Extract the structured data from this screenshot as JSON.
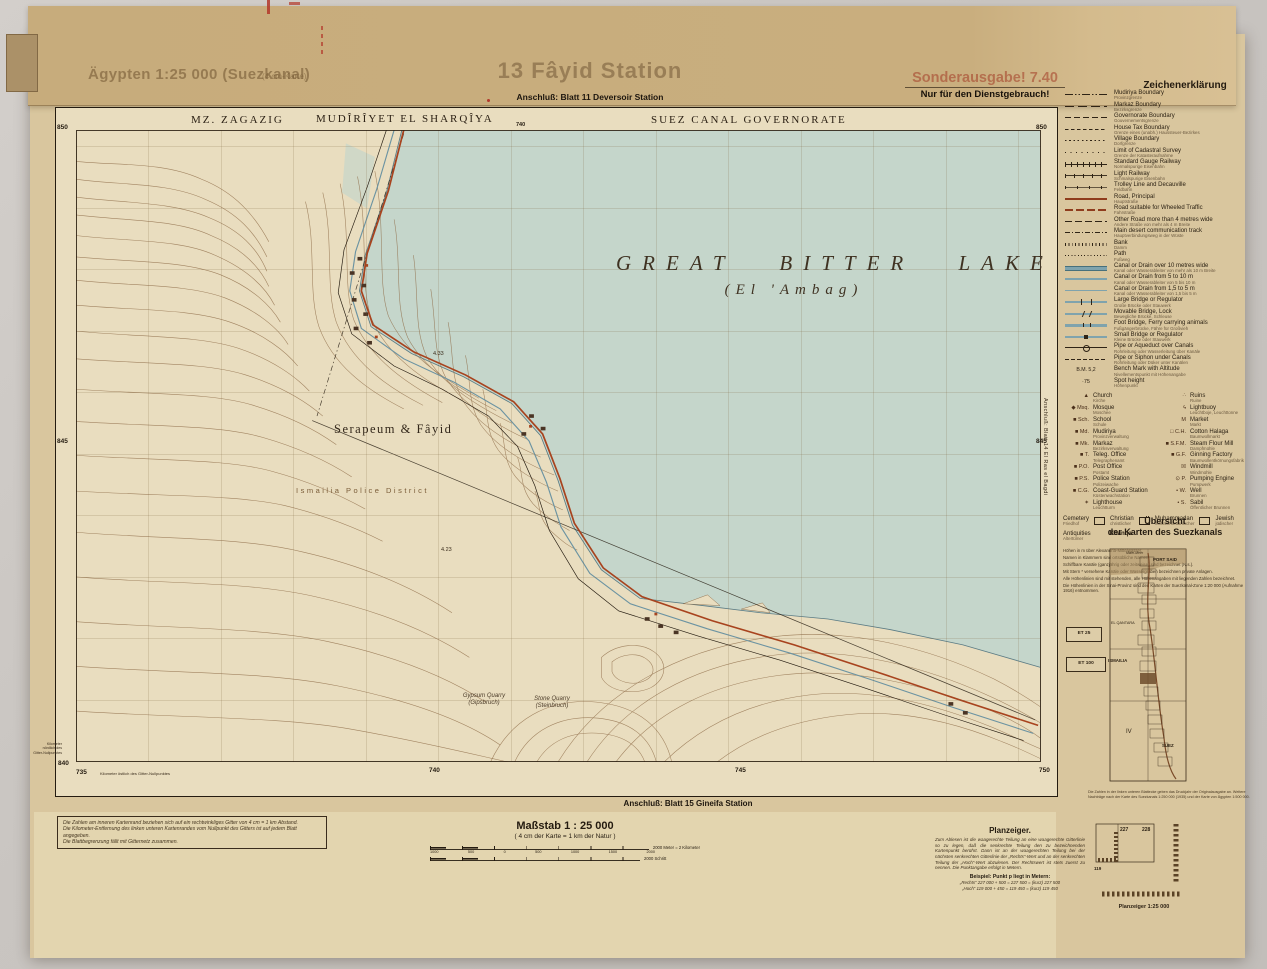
{
  "header": {
    "series_title": "Ägypten 1:25 000 (Suezkanal)",
    "series_note": "(4 cm-Karte)",
    "sheet_title": "13 Fâyid Station",
    "adjoin_top": "Anschluß: Blatt 11 Deversoir Station",
    "edition": "Sonderausgabe! 7.40",
    "restriction": "Nur für den Dienstgebrauch!"
  },
  "map": {
    "admin_left": "MZ. ZAGAZIG",
    "admin_center": "MUDÎRÎYET EL SHARQÎYA",
    "admin_right": "SUEZ CANAL GOVERNORATE",
    "lake_title": "GREAT BITTER LAKE",
    "lake_subtitle": "(El 'Ambag)",
    "place_serapeum": "Serapeum & Fâyid",
    "place_police": "Ismailia Police District",
    "quarry1_en": "Gypsum Quarry",
    "quarry1_de": "(Gipsbruch)",
    "quarry2_en": "Stone Quarry",
    "quarry2_de": "(Steinbruch)",
    "spot1": "4.33",
    "spot2": "4.23",
    "grid": {
      "left_850": "850",
      "left_845": "845",
      "left_840": "840",
      "right_850": "850",
      "right_845": "845",
      "top_740": "740",
      "bottom_735": "735",
      "bottom_740": "740",
      "bottom_745": "745",
      "bottom_750": "750"
    },
    "adjoin_bottom": "Anschluß: Blatt 15 Gineifa Station",
    "adjoin_right": "Anschluß: Blatt 14 El Ras el Bagdi",
    "margin_note_vertical": "Kilometer\nnördlich des\nGitter-Nullpunktes",
    "margin_note_bottom": "Kilometer östlich des Gitter-Nullpunktes"
  },
  "legend": {
    "title": "Zeichenerklärung",
    "items": [
      {
        "en": "Mudiriya Boundary",
        "de": "Provinzgrenze",
        "sym": "dashdotdot"
      },
      {
        "en": "Markaz Boundary",
        "de": "Bezirksgrenze",
        "sym": "dashlong"
      },
      {
        "en": "Governorate Boundary",
        "de": "Gouvernementsgrenze",
        "sym": "dashmed"
      },
      {
        "en": "House Tax Boundary",
        "de": "Grenze eines (unabh.) Haussteuer-Bezirkes",
        "sym": "dashfine"
      },
      {
        "en": "Village Boundary",
        "de": "Dorfgrenze",
        "sym": "dotline"
      },
      {
        "en": "Limit of Cadastral Survey",
        "de": "Grenze der Katasteraufnahme",
        "sym": "dotsparse"
      },
      {
        "en": "Standard Gauge Railway",
        "de": "Normalspurige Eisenbahn",
        "sym": "rail"
      },
      {
        "en": "Light Railway",
        "de": "Schmalspurige Eisenbahn",
        "sym": "raillight"
      },
      {
        "en": "Trolley Line and Decauville",
        "de": "Feldbahn",
        "sym": "trolley"
      },
      {
        "en": "Road, Principal",
        "de": "Hauptstraße",
        "sym": "roadmain"
      },
      {
        "en": "Road suitable for Wheeled Traffic",
        "de": "Fahrstraße",
        "sym": "roadwheel"
      },
      {
        "en": "Other Road more than 4 metres wide",
        "de": "Andere Straße von mehr als 4 m Breite",
        "sym": "roadother"
      },
      {
        "en": "Main desert communication track",
        "de": "Hauptverbindungsweg in der Wüste",
        "sym": "deserttrack"
      },
      {
        "en": "Bank",
        "de": "Damm",
        "sym": "bank"
      },
      {
        "en": "Path",
        "de": "Fußweg",
        "sym": "pathdots"
      },
      {
        "en": "Canal or Drain over 10 metres wide",
        "de": "Kanal oder Wasserableiter von mehr als 10 m Breite",
        "sym": "canal10"
      },
      {
        "en": "Canal or Drain from 5 to 10 m",
        "de": "Kanal oder Wasserableiter von 5 bis 10 m",
        "sym": "canal5"
      },
      {
        "en": "Canal or Drain from 1,5 to 5 m",
        "de": "Kanal oder Wasserableiter von 1,5 bis 5 m",
        "sym": "canal2"
      },
      {
        "en": "Large Bridge or Regulator",
        "de": "Große Brücke oder Stauwerk",
        "sym": "bridgelarge"
      },
      {
        "en": "Movable Bridge, Lock",
        "de": "Bewegliche Brücke, Schleuse",
        "sym": "bridgemove"
      },
      {
        "en": "Foot Bridge, Ferry carrying animals",
        "de": "Fußgängerbrücke, Fähre für Großvieh",
        "sym": "bridgefoot"
      },
      {
        "en": "Small Bridge or Regulator",
        "de": "Kleine Brücke oder Stauwerk",
        "sym": "bridgesmall"
      },
      {
        "en": "Pipe or Aqueduct over Canals",
        "de": "Rohrleitung oder Wasserleitung über Kanäle",
        "sym": "pipeover"
      },
      {
        "en": "Pipe or Siphon under Canals",
        "de": "Rohrleitung oder Düker unter Kanälen",
        "sym": "pipeunder"
      },
      {
        "en": "Bench Mark with Altitude",
        "de": "Nivellementspunkt mit Höhenangabe",
        "sym": "bench"
      },
      {
        "en": "Spot height",
        "de": "Höhenpunkt",
        "sym": "spot"
      }
    ],
    "symbols_left": [
      {
        "g": "▲",
        "en": "Church",
        "de": "Kirche"
      },
      {
        "g": "◆ Msq.",
        "en": "Mosque",
        "de": "Moschee"
      },
      {
        "g": "■ Sch.",
        "en": "School",
        "de": "Schule"
      },
      {
        "g": "■ Md.",
        "en": "Mudiriya",
        "de": "Provinzverwaltung"
      },
      {
        "g": "■ Mk.",
        "en": "Markaz",
        "de": "Bezirksverwaltung"
      },
      {
        "g": "■ T.",
        "en": "Teleg. Office",
        "de": "Telegraphenamt"
      },
      {
        "g": "■ P.O.",
        "en": "Post Office",
        "de": "Postamt"
      },
      {
        "g": "■ P.S.",
        "en": "Police Station",
        "de": "Polizeiwache"
      },
      {
        "g": "■ C.G.",
        "en": "Coast-Guard Station",
        "de": "Küstenwachstation"
      },
      {
        "g": "✶",
        "en": "Lighthouse",
        "de": "Leuchtturm"
      }
    ],
    "symbols_right": [
      {
        "g": "∴",
        "en": "Ruins",
        "de": "Ruine"
      },
      {
        "g": "ϟ",
        "en": "Lightbuoy",
        "de": "Leuchtboje, Leuchttonne"
      },
      {
        "g": "M",
        "en": "Market",
        "de": "Markt"
      },
      {
        "g": "□ C.H.",
        "en": "Cotton Halaga",
        "de": "Baumwollmarkt"
      },
      {
        "g": "■ S.F.M.",
        "en": "Steam Flour Mill",
        "de": "Dampfmühle"
      },
      {
        "g": "■ G.F.",
        "en": "Ginning Factory",
        "de": "Baumwollentkörnungsfabrik"
      },
      {
        "g": "☒",
        "en": "Windmill",
        "de": "Windmühle"
      },
      {
        "g": "⊙ P.",
        "en": "Pumping Engine",
        "de": "Pumpwerk"
      },
      {
        "g": "• W.",
        "en": "Well",
        "de": "Brunnen"
      },
      {
        "g": "• S.",
        "en": "Sabil",
        "de": "Öffentlicher Brunnen"
      }
    ],
    "cemetery": {
      "en": "Cemetery",
      "de": "Friedhof",
      "t1_en": "Christian",
      "t1_de": "christlicher",
      "t2_en": "Muhammadan",
      "t2_de": "mohammedanischer",
      "t3_en": "Jewish",
      "t3_de": "jüdischer"
    },
    "antiquities": {
      "en": "Antiquities",
      "de": "Altertümer",
      "extra": "Khanqa"
    },
    "notes": [
      "Höhen in m über Alexandria-Mittelwasser.",
      "Namen in Klammern sind ortsübliche Namen.",
      "Schiffbare Kanäle (ganzjährig oder zeitweise) sind bezeichnet (N.s.).",
      "Mit Stern * versehene Kanäle oder Wassergräben bezeichnen private Anlagen.",
      "Alle Höhenlinien sind mit stehenden, alle Höhenangaben mit liegenden Zahlen bezeichnet.",
      "Die Höhenlinien in der Sinai-Provinz sind den Karten der Suezkanal-Zone 1:20 000 (Aufnahme 1916) entnommen."
    ]
  },
  "uebersicht": {
    "title1": "Übersicht",
    "title2": "der Karten des Suezkanals",
    "sea": "Mittel-Meer",
    "port_said": "PORT SAID",
    "el_qantara": "EL QANTARA",
    "ismailia": "ISMAILIA",
    "suez": "SUEZ",
    "zone": "IV",
    "et25": "ET 25",
    "et100": "ET 100",
    "note": "Die Zahlen in der linken unteren Blattecke geben das Druckjahr der Originalausgabe an. Weitere Nachträge nach der Karte des Suezkanals 1:250 000 (1935) und der Karte von Ägypten 1:500 000."
  },
  "scale": {
    "title": "Maßstab 1 : 25 000",
    "subtitle": "( 4 cm der Karte = 1 km der Natur )",
    "ticks": [
      "1000",
      "500",
      "0",
      "500",
      "1000",
      "1500",
      "2000"
    ],
    "meter_label": "2000 Meter = 2 Kilometer",
    "schritt_label": "2000 Schritt"
  },
  "notes_box": {
    "lines": [
      "Die Zahlen am inneren Kartenrand beziehen sich auf ein rechtwinkliges Gitter von 4 cm = 1 km Abstand.",
      "Die Kilometer-Entfernung des linken unteren Kartenrandes vom Nullpunkt des Gitters ist auf jedem Blatt angegeben.",
      "Die Blattbegrenzung fällt mit Gitternetz zusammen."
    ]
  },
  "planzeiger": {
    "title": "Planzeiger.",
    "body": "Zum Ablesen ist die waagerechte Teilung an eine waagerechte Gitterlinie so zu legen, daß die senkrechte Teilung den zu bezeichnenden Kartenpunkt berührt. Dann ist an der waagerechten Teilung bei der nächsten senkrechten Gitterlinie der „Rechts“-Wert und an der senkrechten Teilung der „Hoch“-Wert abzulesen. Der Rechtswert ist stets zuerst zu nennen. Die Punktangabe erfolgt in Metern.",
    "example_title": "Beispiel: Punkt p liegt in Metern:",
    "example_line1": "„Rechts“  227 000 + 500 = 227 500 = (kurz) 227 500",
    "example_line2": "„Hoch“  119 000 + 450 = 119 450 = (kurz) 119 450",
    "d1": "227",
    "d2": "228",
    "d3": "119",
    "caption": "Planzeiger 1:25 000"
  }
}
